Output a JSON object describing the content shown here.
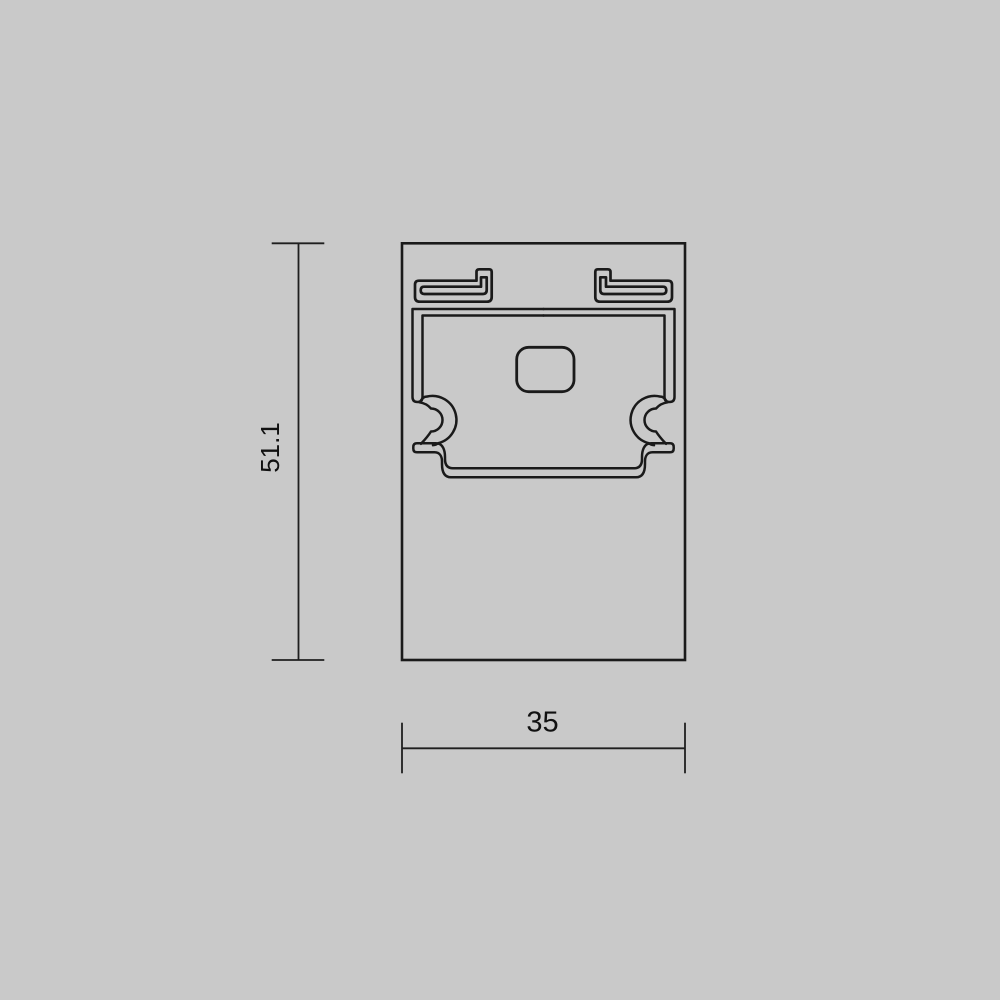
{
  "drawing": {
    "kind": "profile-cross-section-technical-drawing",
    "background_color": "#c9c9c9",
    "line_color": "#1a1a1a",
    "dimensions": {
      "height": {
        "label": "51.1"
      },
      "width": {
        "label": "35"
      }
    }
  }
}
